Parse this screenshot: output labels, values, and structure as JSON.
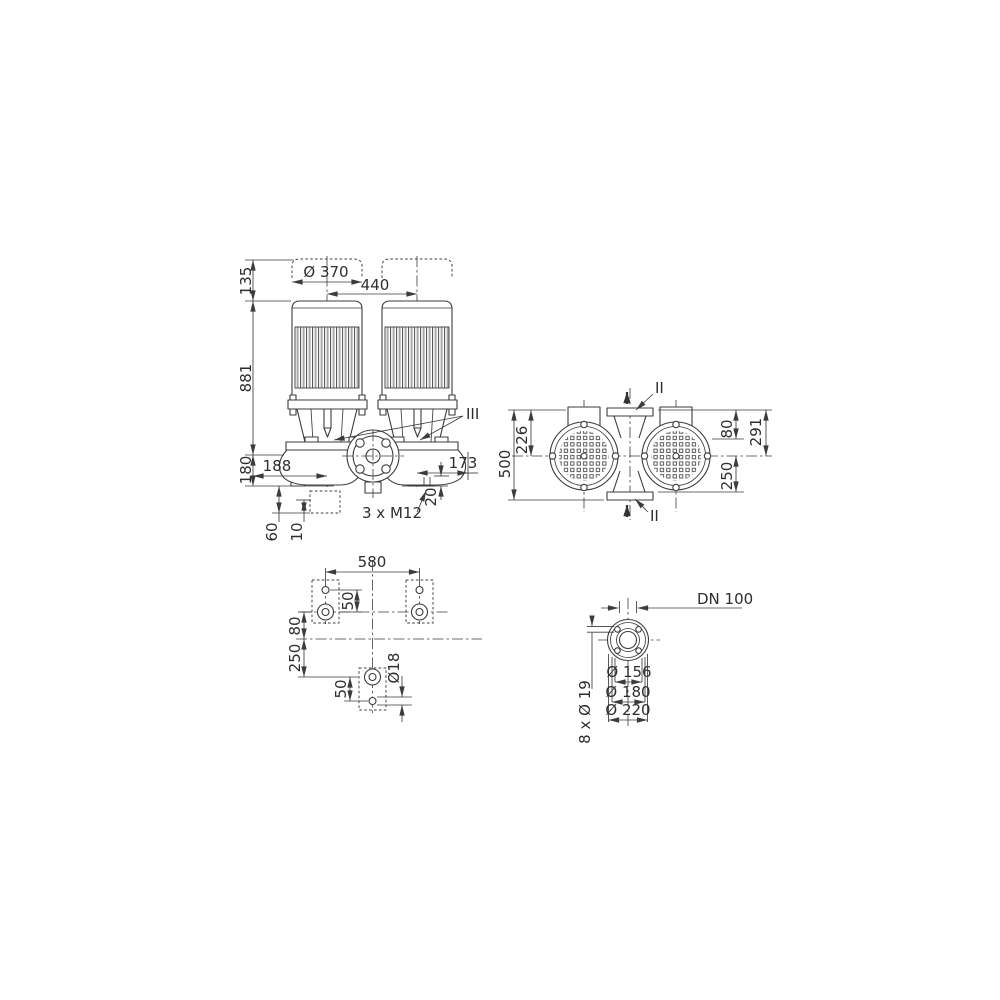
{
  "colors": {
    "background": "#ffffff",
    "line": "#3c3c3c",
    "text": "#2e2e2e"
  },
  "front_view": {
    "dim_motor_clearance": "135",
    "dim_height": "881",
    "dim_base_height": "180",
    "dim_motor_diameter": "Ø 370",
    "dim_axis_spacing": "440",
    "dim_left_offset": "188",
    "dim_right_offset": "173",
    "dim_foot_thickness": "20",
    "label_foundation_bolts": "3 x M12",
    "dim_foundation_depth": "60",
    "dim_grout": "10",
    "marker_drain": "III"
  },
  "side_view": {
    "dim_overall_depth": "500",
    "dim_axis_to_top": "226",
    "dim_port_offset": "80",
    "dim_axis_to_flange_top": "291",
    "dim_axis_to_flange_bottom": "250",
    "marker_port_top": "II",
    "marker_port_bottom": "II"
  },
  "plan_view": {
    "dim_bolt_spacing": "580",
    "dim_upper_hole_offset": "50",
    "dim_axis_offset": "80",
    "dim_lower_bolt_offset": "250",
    "dim_lower_hole_offset": "50",
    "dim_hole_diameter": "Ø18"
  },
  "flange_view": {
    "label_nominal_bore": "DN 100",
    "dim_raised_face": "Ø 156",
    "dim_bolt_circle": "Ø 180",
    "dim_outer_diameter": "Ø 220",
    "label_bolt_holes": "8 x Ø 19"
  }
}
